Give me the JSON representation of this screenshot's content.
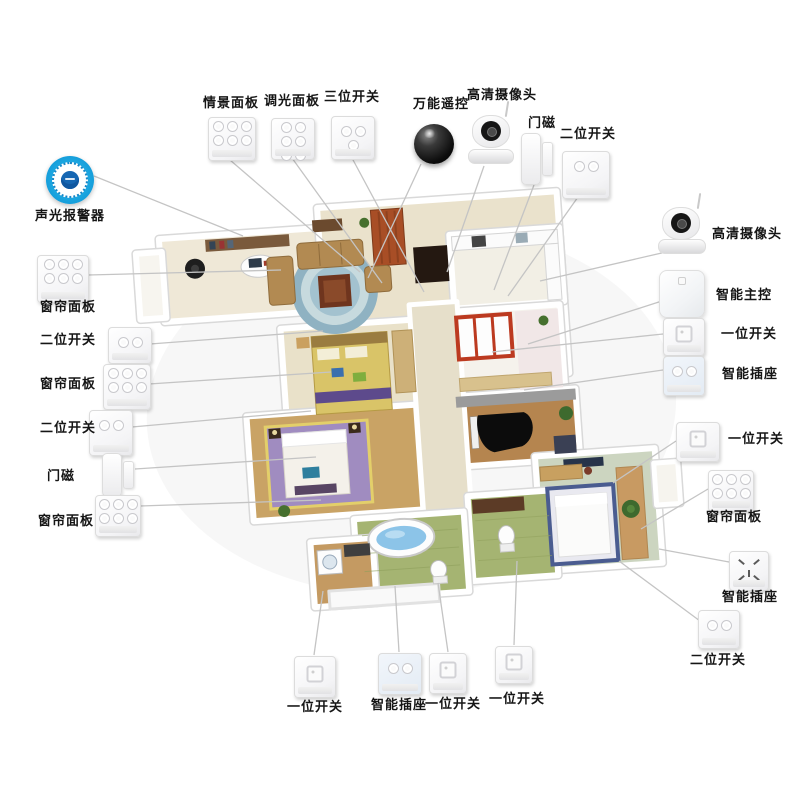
{
  "diagram_type": "smart-home-system-floorplan",
  "colors": {
    "accent_blue": "#1ba6e0",
    "connector_line": "#c4c4c4",
    "label_text": "#151515"
  },
  "devices": [
    {
      "id": "scene-panel",
      "label": "情景面板",
      "type": "panel6",
      "icon": {
        "x": 208,
        "y": 117,
        "w": 46,
        "h": 42
      },
      "text": {
        "x": 186,
        "y": 96,
        "w": 90,
        "align": "center"
      }
    },
    {
      "id": "dimmer-panel",
      "label": "调光面板",
      "type": "panel6",
      "icon": {
        "x": 271,
        "y": 118,
        "w": 42,
        "h": 40
      },
      "text": {
        "x": 252,
        "y": 94,
        "w": 80,
        "align": "center"
      }
    },
    {
      "id": "three-gang-switch",
      "label": "三位开关",
      "type": "panel3",
      "icon": {
        "x": 331,
        "y": 116,
        "w": 42,
        "h": 42
      },
      "text": {
        "x": 314,
        "y": 90,
        "w": 76,
        "align": "center"
      }
    },
    {
      "id": "universal-remote",
      "label": "万能遥控",
      "type": "sphere",
      "icon": {
        "x": 414,
        "y": 124,
        "w": 40,
        "h": 40
      },
      "text": {
        "x": 402,
        "y": 97,
        "w": 78,
        "align": "center"
      }
    },
    {
      "id": "hd-camera-top",
      "label": "高清摄像头",
      "type": "camera",
      "icon": {
        "x": 468,
        "y": 108,
        "w": 44,
        "h": 56
      },
      "text": {
        "x": 460,
        "y": 88,
        "w": 84,
        "align": "center"
      }
    },
    {
      "id": "door-sensor-top",
      "label": "门磁",
      "type": "doorsensor",
      "icon": {
        "x": 520,
        "y": 133,
        "w": 34,
        "h": 50
      },
      "text": {
        "x": 520,
        "y": 116,
        "w": 44,
        "align": "center"
      }
    },
    {
      "id": "two-gang-switch-top",
      "label": "二位开关",
      "type": "panel2",
      "icon": {
        "x": 562,
        "y": 151,
        "w": 46,
        "h": 46
      },
      "text": {
        "x": 552,
        "y": 127,
        "w": 72,
        "align": "center"
      }
    },
    {
      "id": "hd-camera-right",
      "label": "高清摄像头",
      "type": "camera",
      "icon": {
        "x": 658,
        "y": 200,
        "w": 46,
        "h": 54
      },
      "text": {
        "x": 712,
        "y": 227,
        "w": 86,
        "align": "left"
      }
    },
    {
      "id": "smart-hub",
      "label": "智能主控",
      "type": "hub",
      "icon": {
        "x": 659,
        "y": 270,
        "w": 44,
        "h": 46
      },
      "text": {
        "x": 716,
        "y": 288,
        "w": 72,
        "align": "left"
      }
    },
    {
      "id": "one-gang-switch-r1",
      "label": "一位开关",
      "type": "panel1",
      "icon": {
        "x": 663,
        "y": 318,
        "w": 40,
        "h": 36
      },
      "text": {
        "x": 721,
        "y": 327,
        "w": 68,
        "align": "left"
      }
    },
    {
      "id": "smart-socket-r1",
      "label": "智能插座",
      "type": "socket2",
      "icon": {
        "x": 663,
        "y": 356,
        "w": 40,
        "h": 38
      },
      "text": {
        "x": 722,
        "y": 367,
        "w": 68,
        "align": "left"
      }
    },
    {
      "id": "one-gang-switch-r2",
      "label": "一位开关",
      "type": "panel1",
      "icon": {
        "x": 676,
        "y": 422,
        "w": 42,
        "h": 38
      },
      "text": {
        "x": 728,
        "y": 432,
        "w": 68,
        "align": "left"
      }
    },
    {
      "id": "curtain-panel-right",
      "label": "窗帘面板",
      "type": "panel6",
      "icon": {
        "x": 708,
        "y": 470,
        "w": 44,
        "h": 40
      },
      "text": {
        "x": 706,
        "y": 510,
        "w": 72,
        "align": "left"
      }
    },
    {
      "id": "smart-socket-r2",
      "label": "智能插座",
      "type": "socket5",
      "icon": {
        "x": 729,
        "y": 551,
        "w": 38,
        "h": 38
      },
      "text": {
        "x": 722,
        "y": 590,
        "w": 70,
        "align": "left"
      }
    },
    {
      "id": "two-gang-switch-lower",
      "label": "二位开关",
      "type": "panel2",
      "icon": {
        "x": 698,
        "y": 610,
        "w": 40,
        "h": 37
      },
      "text": {
        "x": 690,
        "y": 653,
        "w": 72,
        "align": "left"
      }
    },
    {
      "id": "sound-light-alarm",
      "label": "声光报警器",
      "type": "alarm",
      "icon": {
        "x": 46,
        "y": 156,
        "w": 48,
        "h": 48
      },
      "text": {
        "x": 26,
        "y": 209,
        "w": 88,
        "align": "center"
      }
    },
    {
      "id": "curtain-panel-l1",
      "label": "窗帘面板",
      "type": "panel6",
      "icon": {
        "x": 37,
        "y": 255,
        "w": 50,
        "h": 46
      },
      "text": {
        "x": 30,
        "y": 300,
        "w": 76,
        "align": "center"
      }
    },
    {
      "id": "two-gang-switch-l1",
      "label": "二位开关",
      "type": "panel2",
      "icon": {
        "x": 108,
        "y": 327,
        "w": 42,
        "h": 35
      },
      "text": {
        "x": 40,
        "y": 333,
        "w": 62,
        "align": "left"
      }
    },
    {
      "id": "curtain-panel-l2",
      "label": "窗帘面板",
      "type": "panel6",
      "icon": {
        "x": 103,
        "y": 364,
        "w": 46,
        "h": 44
      },
      "text": {
        "x": 40,
        "y": 377,
        "w": 62,
        "align": "left"
      }
    },
    {
      "id": "two-gang-switch-l2",
      "label": "二位开关",
      "type": "panel2",
      "icon": {
        "x": 89,
        "y": 410,
        "w": 42,
        "h": 44
      },
      "text": {
        "x": 40,
        "y": 421,
        "w": 62,
        "align": "left"
      }
    },
    {
      "id": "door-sensor-left",
      "label": "门磁",
      "type": "doorsensor",
      "icon": {
        "x": 101,
        "y": 453,
        "w": 34,
        "h": 42
      },
      "text": {
        "x": 47,
        "y": 469,
        "w": 44,
        "align": "left"
      }
    },
    {
      "id": "curtain-panel-l3",
      "label": "窗帘面板",
      "type": "panel6",
      "icon": {
        "x": 95,
        "y": 495,
        "w": 44,
        "h": 40
      },
      "text": {
        "x": 38,
        "y": 514,
        "w": 62,
        "align": "left"
      }
    },
    {
      "id": "one-gang-switch-b1",
      "label": "一位开关",
      "type": "panel1",
      "icon": {
        "x": 294,
        "y": 656,
        "w": 40,
        "h": 40
      },
      "text": {
        "x": 284,
        "y": 700,
        "w": 62,
        "align": "center"
      }
    },
    {
      "id": "smart-socket-bottom",
      "label": "智能插座",
      "type": "socket2",
      "icon": {
        "x": 378,
        "y": 653,
        "w": 42,
        "h": 40
      },
      "text": {
        "x": 368,
        "y": 698,
        "w": 62,
        "align": "center"
      }
    },
    {
      "id": "one-gang-switch-b2",
      "label": "一位开关",
      "type": "panel1",
      "icon": {
        "x": 429,
        "y": 653,
        "w": 36,
        "h": 39
      },
      "text": {
        "x": 422,
        "y": 697,
        "w": 62,
        "align": "center"
      }
    },
    {
      "id": "one-gang-switch-b3",
      "label": "一位开关",
      "type": "panel1",
      "icon": {
        "x": 495,
        "y": 646,
        "w": 36,
        "h": 36
      },
      "text": {
        "x": 486,
        "y": 692,
        "w": 62,
        "align": "center"
      }
    }
  ],
  "connectors": [
    [
      230,
      160,
      360,
      272
    ],
    [
      292,
      158,
      382,
      283
    ],
    [
      352,
      158,
      424,
      292
    ],
    [
      421,
      164,
      368,
      278
    ],
    [
      484,
      166,
      447,
      272
    ],
    [
      534,
      185,
      494,
      290
    ],
    [
      578,
      197,
      508,
      296
    ],
    [
      666,
      252,
      540,
      281
    ],
    [
      665,
      300,
      528,
      344
    ],
    [
      663,
      334,
      492,
      352
    ],
    [
      663,
      370,
      524,
      390
    ],
    [
      676,
      441,
      613,
      483
    ],
    [
      708,
      489,
      641,
      529
    ],
    [
      729,
      562,
      659,
      549
    ],
    [
      700,
      621,
      619,
      561
    ],
    [
      94,
      176,
      243,
      236
    ],
    [
      88,
      275,
      281,
      270
    ],
    [
      150,
      344,
      323,
      331
    ],
    [
      149,
      384,
      331,
      372
    ],
    [
      132,
      427,
      311,
      411
    ],
    [
      135,
      469,
      316,
      457
    ],
    [
      140,
      506,
      321,
      500
    ],
    [
      314,
      655,
      323,
      591
    ],
    [
      399,
      652,
      395,
      586
    ],
    [
      448,
      652,
      438,
      583
    ],
    [
      514,
      645,
      517,
      561
    ]
  ]
}
